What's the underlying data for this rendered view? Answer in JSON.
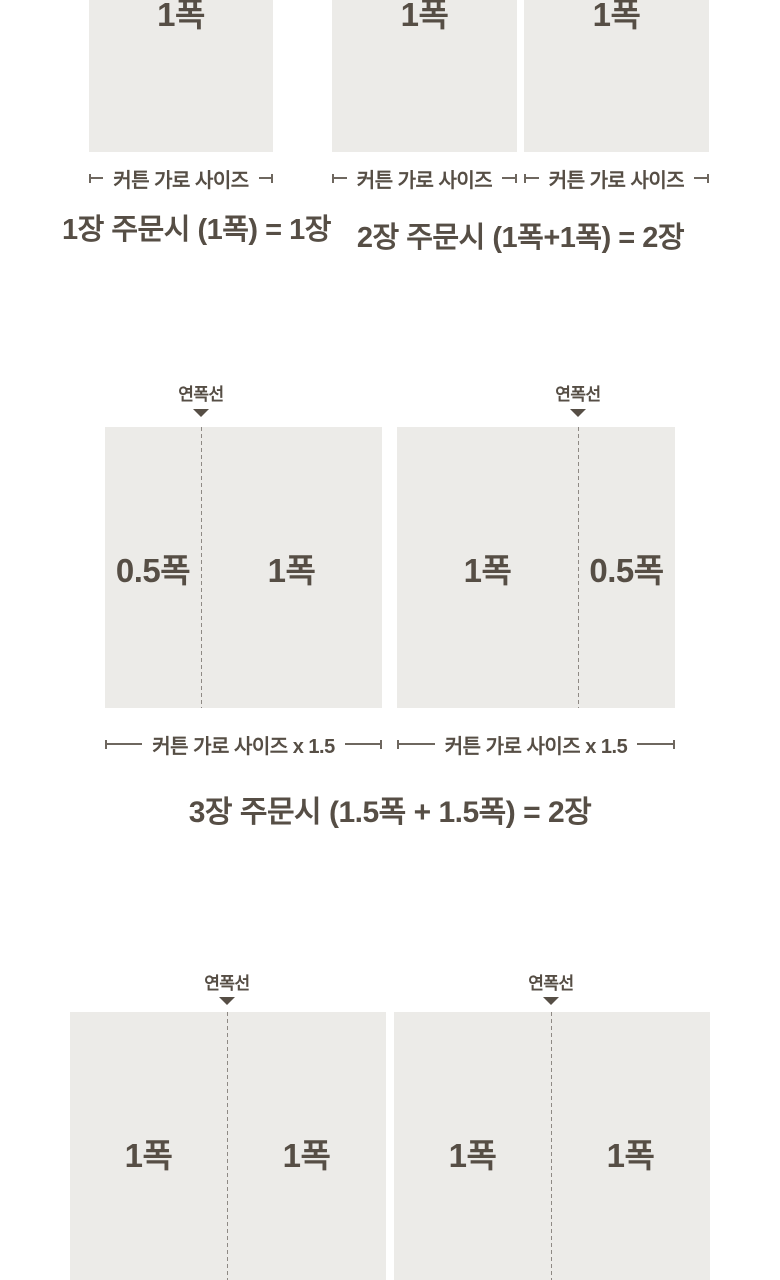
{
  "colors": {
    "page_background": "#ffffff",
    "panel_fill": "#ecebe8",
    "text": "#564e45",
    "dashed_join_line": "#8e8984",
    "measure_line": "#6e675f"
  },
  "top": {
    "panel1_label": "1폭",
    "panel2_label": "1폭",
    "panel3_label": "1폭",
    "measure_label": "커튼 가로 사이즈",
    "caption_left": "1장 주문시 (1폭) = 1장",
    "caption_right": "2장 주문시 (1폭+1폭) = 2장"
  },
  "middle": {
    "join_label_left": "연폭선",
    "join_label_right": "연폭선",
    "left_panel": {
      "left_label": "0.5폭",
      "right_label": "1폭"
    },
    "right_panel": {
      "left_label": "1폭",
      "right_label": "0.5폭"
    },
    "measure_label": "커튼 가로 사이즈 x 1.5",
    "caption": "3장 주문시 (1.5폭 + 1.5폭) = 2장"
  },
  "bottom": {
    "join_label_left": "연폭선",
    "join_label_right": "연폭선",
    "left_panel": {
      "left_label": "1폭",
      "right_label": "1폭"
    },
    "right_panel": {
      "left_label": "1폭",
      "right_label": "1폭"
    }
  }
}
